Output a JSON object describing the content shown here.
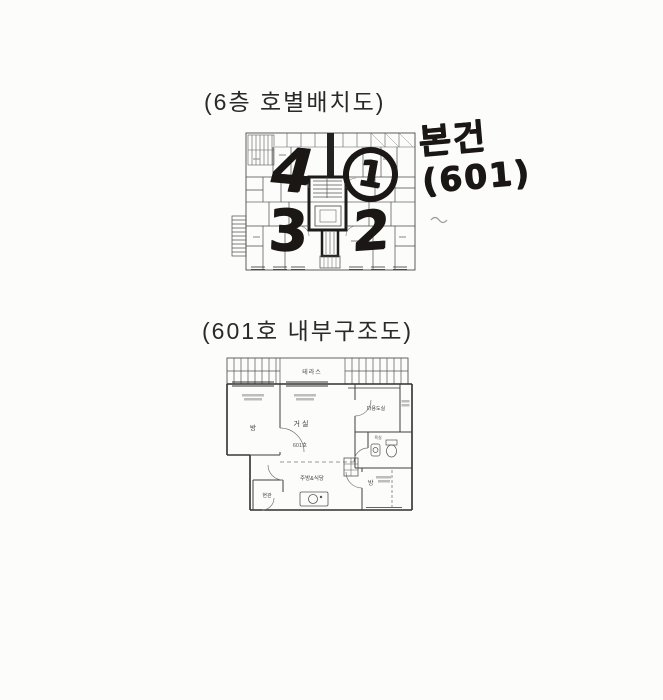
{
  "section1": {
    "title": "(6층 호별배치도)",
    "annotations": {
      "unit4": "4",
      "unit1": "1",
      "unit3": "3",
      "unit2": "2"
    },
    "note": {
      "line1": "본건",
      "line2": "(601)"
    }
  },
  "section2": {
    "title": "(601호 내부구조도)",
    "rooms": {
      "terrace": "테라스",
      "left_room": "방",
      "living": "거실",
      "unit_number": "601호",
      "utility": "다용도실",
      "bath": "욕실",
      "kitchen": "주방&식당",
      "entrance": "현관",
      "right_room": "방"
    }
  },
  "colors": {
    "paper": "#fcfcfa",
    "print_line": "#444444",
    "marker": "#1a1714"
  }
}
